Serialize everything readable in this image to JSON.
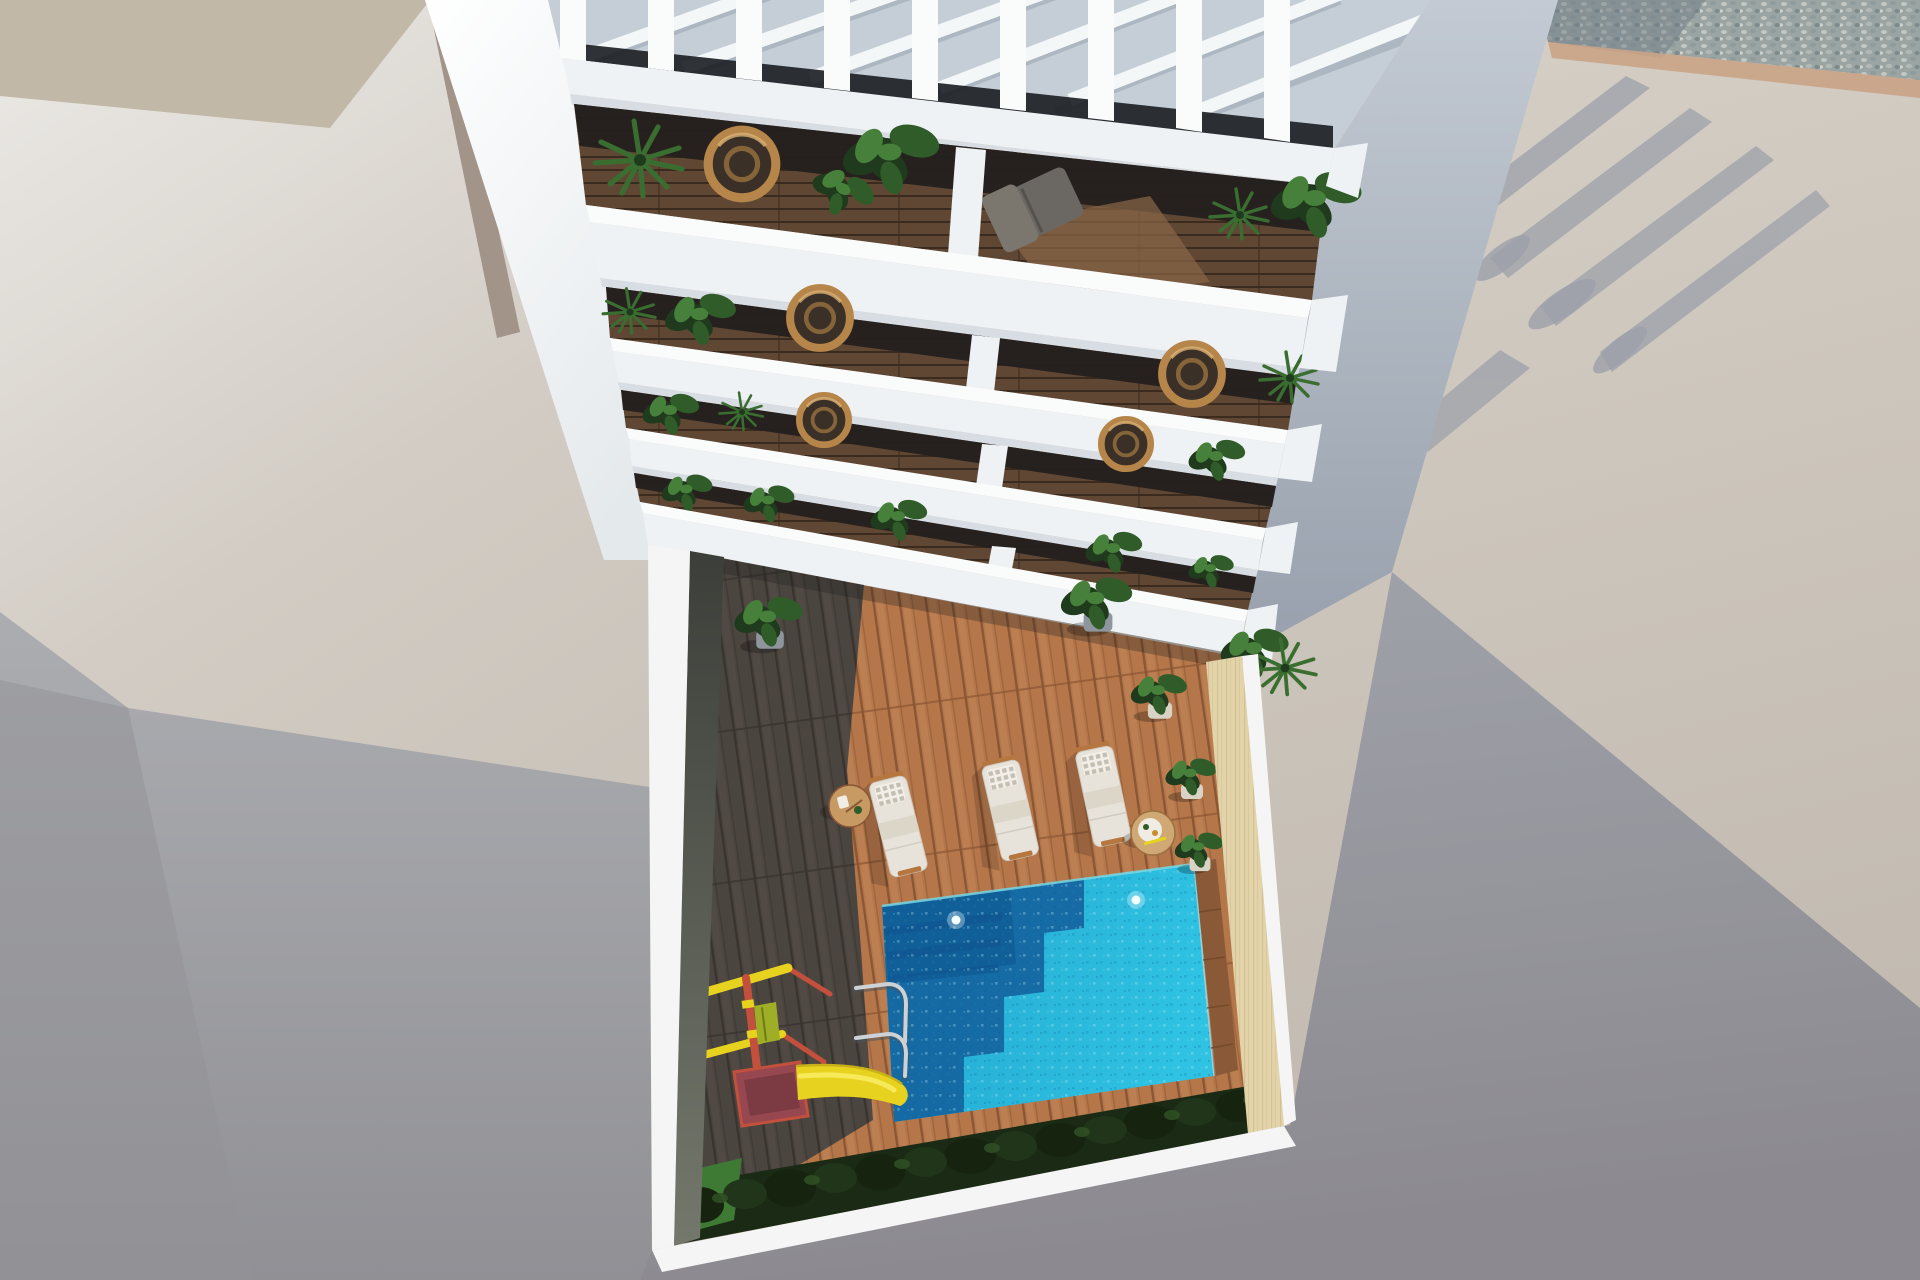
{
  "scene": {
    "type": "architectural-3d-render",
    "view": "aerial top-down view of a white apartment building with tiered balconies above a courtyard with swimming pool, sun loungers, wooden deck and children's slide",
    "time_of_day": "sunny, hard shadows cast to lower-left",
    "palette": {
      "ground_left_bright": "#e9e7e3",
      "ground_left": "#cbc4bb",
      "ground_tan_patch": "#c2b8a7",
      "neighbor_wall_tan": "#a3948a",
      "shadow_left": "#a7a8ad",
      "shadow_left_deep": "#939398",
      "ground_right_bright": "#d7d1c8",
      "ground_right": "#c5bdb2",
      "shadow_right": "#9da1aa",
      "shadow_right_deep": "#8d8b90",
      "gravel_base": "#9aa4a3",
      "gravel_shade": "#6f7b85",
      "curb_tan": "#c9a183",
      "building_white": "#eff2f4",
      "building_bright": "#fafbfb",
      "parapet_shade": "#d7dde2",
      "pergola_bg": "#c5ced7",
      "pergola_beam": "#f4f7f8",
      "pergola_beam_shadow": "#a9b3bf",
      "window_dark": "#1d2125",
      "glass_dark": "#23201d",
      "side_wall_top": "#c1c8d1",
      "side_wall_bot": "#99a2ae",
      "balc_wood": "#5f4734",
      "balc_wood_dark": "#3a2b1e",
      "balc_wood_lit": "#8a6647",
      "deck_sun": "#b5774a",
      "deck_sun_line": "#8a5634",
      "deck_sun_hi": "#c28758",
      "deck_shade": "#4b4540",
      "deck_shade_line": "#39342f",
      "deck_shade_hi": "#585149",
      "inner_wall_dark": "#41443d",
      "inner_wall_light": "#6f7368",
      "cream_wall": "#e3d3a9",
      "cream_grain": "#c3ae80",
      "wood_border": "#8a5a38",
      "pool_bright": "#2abadc",
      "pool_mid": "#1fa3cc",
      "pool_shadow": "#14639e",
      "pool_deep": "#0f5590",
      "waterline": "#7adbe8",
      "lounger_white": "#e7e3da",
      "lounger_edge": "#cfcabf",
      "towel": "#dcd6c9",
      "pillow": "#f2efe8",
      "pillow_dot": "#b9b3a6",
      "lounger_frame": "#b5763f",
      "table_wood": "#c79a63",
      "green_dark": "#1f3a1c",
      "green_mid": "#2f5c28",
      "green_light": "#47803a",
      "green_palm": "#3a6e31",
      "pot_gray": "#8e959c",
      "pot_cream": "#d9d3c6",
      "bush_under": "#1a2a14",
      "bush_dark": "#16240f",
      "bush_mid": "#20351a",
      "bush_light": "#2f4f23",
      "grass": "#3f7a35",
      "play_red": "#c2503c",
      "play_yellow": "#e8d220",
      "play_yellow_hi": "#f6ea5a",
      "play_green": "#9fae27",
      "play_maroon": "#97474f",
      "ladder_chrome": "#cdd2d6",
      "white_band": "#f4f5f4"
    },
    "objects": [
      "pergola-roof",
      "roof-slats",
      "roof-beams",
      "balcony-floor-1",
      "balcony-floor-2",
      "balcony-floor-3",
      "balcony-floor-4",
      "balcony-parapets",
      "balcony-plants",
      "wicker-chairs",
      "recliner-chair",
      "building-side-wall",
      "building-west-wall",
      "courtyard",
      "wood-deck-sunlit",
      "wood-deck-shadow",
      "swimming-pool",
      "pool-steps",
      "pool-ladder",
      "pool-lights",
      "sun-lounger-1",
      "sun-lounger-2",
      "sun-lounger-3",
      "side-table-1",
      "side-table-2",
      "potted-plants",
      "kids-playground",
      "kids-slide",
      "hedge-bushes",
      "grass-patch",
      "perimeter-wall-cream",
      "perimeter-wall-white",
      "gravel-strip",
      "curb-strip",
      "cast-shadow-left",
      "cast-shadow-right",
      "pergola-stripe-shadows"
    ]
  }
}
